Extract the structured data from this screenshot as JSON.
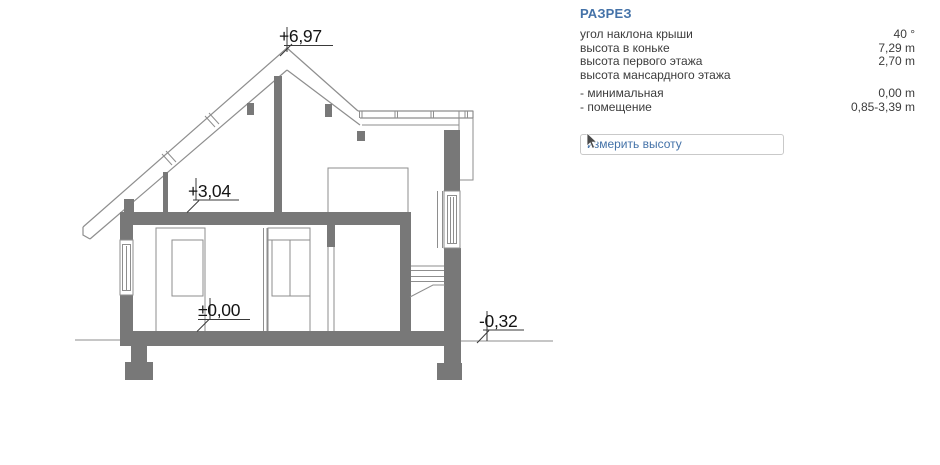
{
  "panel": {
    "title": "РАЗРЕЗ",
    "rows": [
      {
        "label": "угол наклона крыши",
        "value": "40 °"
      },
      {
        "label": "высота в коньке",
        "value": "7,29 m"
      },
      {
        "label": "высота первого этажа",
        "value": "2,70 m"
      },
      {
        "label": "высота мансардного этажа",
        "value": ""
      },
      {
        "label": "- минимальная",
        "value": "0,00 m"
      },
      {
        "label": "- помещение",
        "value": "0,85-3,39 m"
      }
    ],
    "measure_button_label": "измерить высоту"
  },
  "drawing": {
    "levels": {
      "ridge": {
        "text": "+6,97"
      },
      "attic_floor": {
        "text": "+3,04"
      },
      "ground_floor": {
        "text": "±0,00"
      },
      "terrain": {
        "text": "-0,32"
      }
    },
    "colors": {
      "wall_fill": "#787878",
      "drawing_line": "#8e8e8e",
      "dimension_text": "#141414",
      "accent_blue": "#4472a8",
      "button_border": "#c9c9c9"
    }
  }
}
